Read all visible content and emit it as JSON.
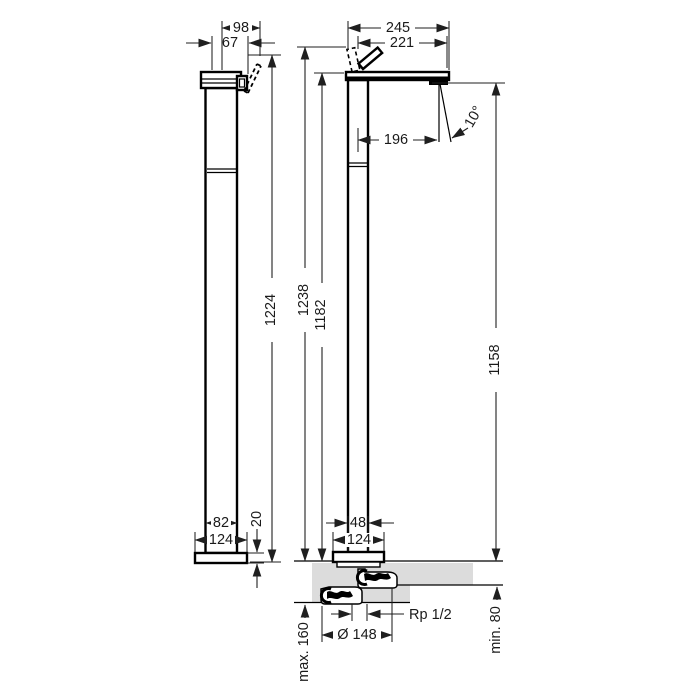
{
  "drawing": {
    "dims": {
      "d98": "98",
      "d67": "67",
      "d1224": "1224",
      "d82": "82",
      "d124_left": "124",
      "d20": "20",
      "d245": "245",
      "d221": "221",
      "d196": "196",
      "d_angle": "10°",
      "d1238": "1238",
      "d1182": "1182",
      "d1158": "1158",
      "d48": "48",
      "d124_right": "124",
      "d_max160": "max. 160",
      "d_dia148": "Ø 148",
      "d_rp": "Rp 1/2",
      "d_min80": "min. 80"
    },
    "colors": {
      "line": "#1a1a1a",
      "floor_fill": "#dcdcdc",
      "background": "#ffffff"
    }
  }
}
